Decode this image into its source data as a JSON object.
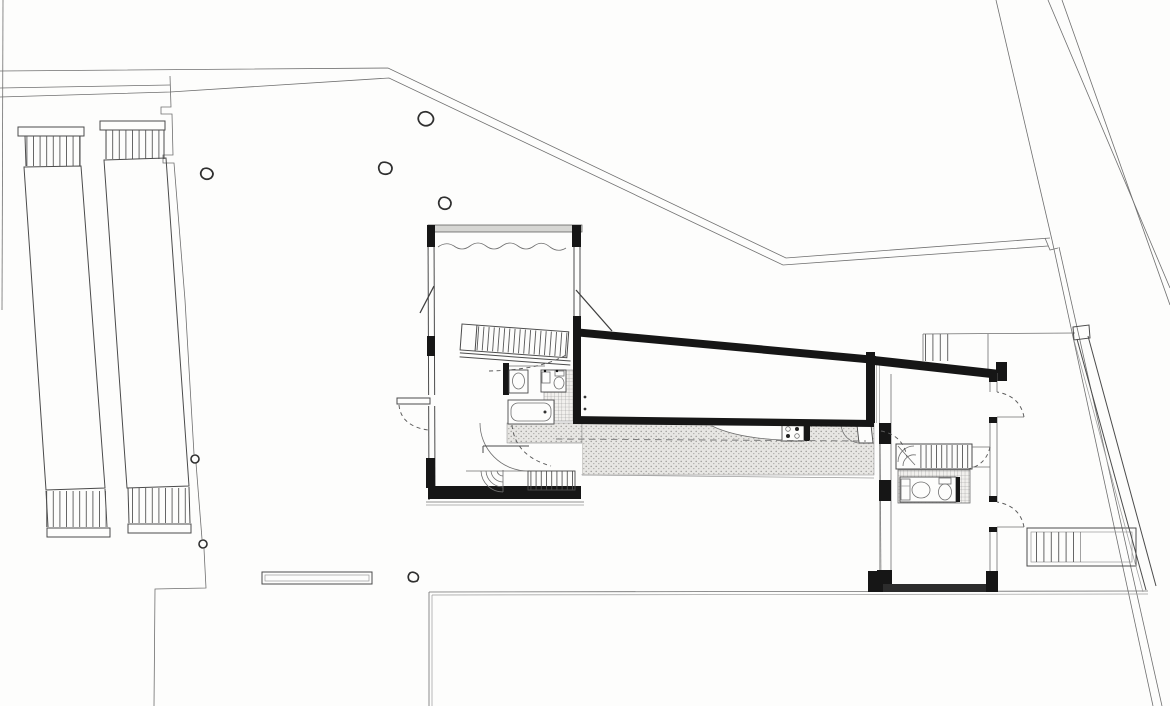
{
  "meta": {
    "kind": "architectural floor plan, black and white line drawing",
    "domain_note": "site plan with house: bedroom block, sloping living wing, guest wing, stippled gallery deck"
  },
  "palette": {
    "paper": "#fdfdfc",
    "line": "#4b4b4b",
    "wall_black": "#161616",
    "stipple_bg": "#e7e6e3",
    "stipple_dot": "#9e9d9a",
    "tile_bg": "#f1f0ed",
    "tile_line": "#8f8f8f"
  },
  "features": {
    "site": {
      "boundary": "property boundary line",
      "path": "bent garden path",
      "diagonals": "street edge diagonals",
      "fence": "garden fence with gate posts",
      "pergola_left": "trellis row west",
      "pergola_right": "trellis row east",
      "bench": "garden bench",
      "stones": "boulders",
      "terrace": "lower terrace edge"
    },
    "house": {
      "bedroom_block": "bedroom block",
      "curtain": "wavy wardrobe line",
      "main_stair": "straight stair",
      "bathroom": "bathroom",
      "washbasin": "washbasin",
      "toilet": "wc and hand basin",
      "bathtub": "bathtub",
      "tiled_floor": "tiled floor",
      "winder_stair": "curved lower stair",
      "lower_stair_straight": "straight lower stair",
      "corridor": "stippled gallery deck",
      "kitchen": "kitchen hob",
      "entry_door": "deck door with swing",
      "living_room": "living room wing",
      "guest_wing": "guest wing",
      "spiral_stair": "stair with winders",
      "guest_bath": "guest bathroom",
      "upper_ext_stair": "upper exterior stair",
      "lower_ext_stair": "lower exterior stair",
      "ramp": "sloping retaining wall"
    }
  }
}
